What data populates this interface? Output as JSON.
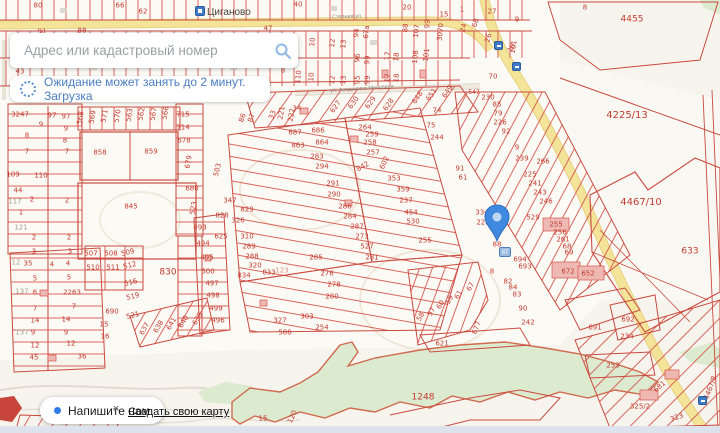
{
  "search": {
    "placeholder": "Адрес или кадастровый номер"
  },
  "loader": {
    "text": "Ожидание может занять до 2 минут. Загрузка"
  },
  "footer": {
    "chat_label": "Напишите нам",
    "close_label": "×",
    "create_map_label": "Создать свою карту"
  },
  "map": {
    "place_label": "Циганово",
    "street_labels": [
      {
        "text": "Степная ул."
      },
      {
        "text": "ул. Академика Мичурина"
      },
      {
        "text": "ул."
      }
    ],
    "marker": {
      "parcel": "88",
      "badge": "87"
    },
    "colors": {
      "parcel_line": "#d6554b",
      "parcel_text": "#c23b30",
      "road_fill": "#f3e49a",
      "forest": "#dcead0",
      "pin": "#3f8ae0",
      "ui_accent": "#4a7dc0"
    },
    "parcel_labels": [
      {
        "t": "80",
        "x": 38,
        "y": 6
      },
      {
        "t": "66",
        "x": 120,
        "y": 6
      },
      {
        "t": "62",
        "x": 143,
        "y": 12
      },
      {
        "t": "91",
        "x": 42,
        "y": 32
      },
      {
        "t": "88",
        "x": 82,
        "y": 31
      },
      {
        "t": "47",
        "x": 268,
        "y": 29
      },
      {
        "t": "40",
        "x": 298,
        "y": 5
      },
      {
        "t": "20",
        "x": 407,
        "y": 8
      },
      {
        "t": "15",
        "x": 444,
        "y": 15
      },
      {
        "t": "1",
        "x": 462,
        "y": 10
      },
      {
        "t": "27",
        "x": 492,
        "y": 12
      },
      {
        "t": "9",
        "x": 517,
        "y": 20
      },
      {
        "t": "8",
        "x": 585,
        "y": 8
      },
      {
        "t": "4455",
        "x": 632,
        "y": 20,
        "s": 9
      },
      {
        "t": "24",
        "x": 464,
        "y": 28,
        "r": -75
      },
      {
        "t": "68",
        "x": 476,
        "y": 23,
        "r": -75
      },
      {
        "t": "26",
        "x": 489,
        "y": 38,
        "r": -75
      },
      {
        "t": "101",
        "x": 514,
        "y": 47,
        "r": -80
      },
      {
        "t": "3070",
        "x": 441,
        "y": 32,
        "r": -85
      },
      {
        "t": "107",
        "x": 417,
        "y": 31,
        "r": -85
      },
      {
        "t": "99",
        "x": 428,
        "y": 24,
        "r": -85
      },
      {
        "t": "88",
        "x": 406,
        "y": 28,
        "r": -85
      },
      {
        "t": "94",
        "x": 357,
        "y": 33,
        "r": -85
      },
      {
        "t": "67а",
        "x": 367,
        "y": 32,
        "r": -85
      },
      {
        "t": "10",
        "x": 313,
        "y": 42,
        "r": -85
      },
      {
        "t": "12",
        "x": 333,
        "y": 43,
        "r": -85
      },
      {
        "t": "13",
        "x": 344,
        "y": 44,
        "r": -85
      },
      {
        "t": "96",
        "x": 358,
        "y": 58,
        "r": -85
      },
      {
        "t": "99",
        "x": 368,
        "y": 60,
        "r": -85
      },
      {
        "t": "17",
        "x": 388,
        "y": 56,
        "r": -85
      },
      {
        "t": "18",
        "x": 397,
        "y": 57,
        "r": -85
      },
      {
        "t": "108",
        "x": 416,
        "y": 57,
        "r": -85
      },
      {
        "t": "101",
        "x": 427,
        "y": 55,
        "r": -85
      },
      {
        "t": "95",
        "x": 358,
        "y": 80,
        "r": -85
      },
      {
        "t": "99",
        "x": 368,
        "y": 80,
        "r": -85
      },
      {
        "t": "17",
        "x": 388,
        "y": 78,
        "r": -85
      },
      {
        "t": "18",
        "x": 397,
        "y": 78,
        "r": -85
      },
      {
        "t": "12",
        "x": 333,
        "y": 80,
        "r": -85
      },
      {
        "t": "13",
        "x": 344,
        "y": 80,
        "r": -85
      },
      {
        "t": "110",
        "x": 299,
        "y": 77,
        "r": -85
      },
      {
        "t": "10",
        "x": 312,
        "y": 77,
        "r": -85
      },
      {
        "t": "8",
        "x": 283,
        "y": 71
      },
      {
        "t": "43",
        "x": 20,
        "y": 72
      },
      {
        "t": "10",
        "x": 512,
        "y": 48,
        "r": -60
      },
      {
        "t": "70",
        "x": 493,
        "y": 77
      },
      {
        "t": "547",
        "x": 474,
        "y": 93,
        "s": 6
      },
      {
        "t": "230",
        "x": 488,
        "y": 98
      },
      {
        "t": "85",
        "x": 497,
        "y": 105
      },
      {
        "t": "74",
        "x": 437,
        "y": 111
      },
      {
        "t": "75",
        "x": 431,
        "y": 126
      },
      {
        "t": "244",
        "x": 437,
        "y": 138
      },
      {
        "t": "627",
        "x": 336,
        "y": 107,
        "r": -55
      },
      {
        "t": "630",
        "x": 354,
        "y": 103,
        "r": -55
      },
      {
        "t": "629",
        "x": 371,
        "y": 103,
        "r": -55
      },
      {
        "t": "628",
        "x": 389,
        "y": 105,
        "r": -55
      },
      {
        "t": "648",
        "x": 418,
        "y": 98,
        "r": -55
      },
      {
        "t": "651",
        "x": 432,
        "y": 95,
        "r": -55
      },
      {
        "t": "649",
        "x": 448,
        "y": 92,
        "r": -55
      },
      {
        "t": "86",
        "x": 243,
        "y": 118,
        "r": -70
      },
      {
        "t": "87",
        "x": 252,
        "y": 118,
        "r": -70
      },
      {
        "t": "33",
        "x": 273,
        "y": 115,
        "r": -70
      },
      {
        "t": "221",
        "x": 282,
        "y": 113,
        "r": -80
      },
      {
        "t": "222",
        "x": 292,
        "y": 115,
        "r": -80
      },
      {
        "t": "34",
        "x": 297,
        "y": 109
      },
      {
        "t": "3247",
        "x": 20,
        "y": 115
      },
      {
        "t": "97",
        "x": 52,
        "y": 116
      },
      {
        "t": "97",
        "x": 66,
        "y": 117
      },
      {
        "t": "9",
        "x": 41,
        "y": 125
      },
      {
        "t": "9",
        "x": 66,
        "y": 129
      },
      {
        "t": "8",
        "x": 27,
        "y": 136
      },
      {
        "t": "8",
        "x": 65,
        "y": 141
      },
      {
        "t": "7",
        "x": 27,
        "y": 152
      },
      {
        "t": "7",
        "x": 67,
        "y": 152
      },
      {
        "t": "109",
        "x": 13,
        "y": 175
      },
      {
        "t": "110",
        "x": 41,
        "y": 176
      },
      {
        "t": "44",
        "x": 18,
        "y": 191
      },
      {
        "t": "117",
        "x": 15,
        "y": 202,
        "g": 1
      },
      {
        "t": "2",
        "x": 32,
        "y": 200
      },
      {
        "t": "2",
        "x": 67,
        "y": 201
      },
      {
        "t": "1",
        "x": 21,
        "y": 213
      },
      {
        "t": "121",
        "x": 21,
        "y": 228,
        "g": 1
      },
      {
        "t": "2",
        "x": 34,
        "y": 238
      },
      {
        "t": "2",
        "x": 69,
        "y": 238
      },
      {
        "t": "3",
        "x": 34,
        "y": 252
      },
      {
        "t": "3",
        "x": 70,
        "y": 252
      },
      {
        "t": "35",
        "x": 28,
        "y": 264
      },
      {
        "t": "12",
        "x": 16,
        "y": 263,
        "g": 1
      },
      {
        "t": "4",
        "x": 52,
        "y": 265
      },
      {
        "t": "4",
        "x": 68,
        "y": 264
      },
      {
        "t": "5",
        "x": 35,
        "y": 279
      },
      {
        "t": "5",
        "x": 69,
        "y": 278
      },
      {
        "t": "6",
        "x": 35,
        "y": 293
      },
      {
        "t": "137",
        "x": 22,
        "y": 292,
        "g": 1
      },
      {
        "t": "2263",
        "x": 72,
        "y": 293
      },
      {
        "t": "7",
        "x": 35,
        "y": 309
      },
      {
        "t": "7",
        "x": 74,
        "y": 307
      },
      {
        "t": "14",
        "x": 35,
        "y": 321
      },
      {
        "t": "14",
        "x": 66,
        "y": 320
      },
      {
        "t": "9",
        "x": 33,
        "y": 333
      },
      {
        "t": "9",
        "x": 66,
        "y": 333
      },
      {
        "t": "137",
        "x": 22,
        "y": 333,
        "g": 1
      },
      {
        "t": "12",
        "x": 35,
        "y": 346
      },
      {
        "t": "12",
        "x": 71,
        "y": 344
      },
      {
        "t": "45",
        "x": 34,
        "y": 358
      },
      {
        "t": "36",
        "x": 82,
        "y": 357
      },
      {
        "t": "568",
        "x": 81,
        "y": 118,
        "r": -80
      },
      {
        "t": "569",
        "x": 93,
        "y": 117,
        "r": -80
      },
      {
        "t": "571",
        "x": 105,
        "y": 116,
        "r": -80
      },
      {
        "t": "570",
        "x": 118,
        "y": 116,
        "r": -80
      },
      {
        "t": "563",
        "x": 130,
        "y": 115,
        "r": -80
      },
      {
        "t": "562",
        "x": 142,
        "y": 114,
        "r": -80
      },
      {
        "t": "567",
        "x": 154,
        "y": 114,
        "r": -80
      },
      {
        "t": "566",
        "x": 166,
        "y": 113,
        "r": -80
      },
      {
        "t": "715",
        "x": 183,
        "y": 115
      },
      {
        "t": "714",
        "x": 183,
        "y": 128
      },
      {
        "t": "678",
        "x": 184,
        "y": 141
      },
      {
        "t": "679",
        "x": 189,
        "y": 162,
        "r": -80
      },
      {
        "t": "858",
        "x": 100,
        "y": 153
      },
      {
        "t": "859",
        "x": 151,
        "y": 152
      },
      {
        "t": "845",
        "x": 131,
        "y": 207
      },
      {
        "t": "680",
        "x": 192,
        "y": 189
      },
      {
        "t": "503",
        "x": 218,
        "y": 170,
        "r": -75
      },
      {
        "t": "523",
        "x": 194,
        "y": 208,
        "r": -80
      },
      {
        "t": "347",
        "x": 230,
        "y": 201
      },
      {
        "t": "829",
        "x": 247,
        "y": 210
      },
      {
        "t": "828",
        "x": 222,
        "y": 216
      },
      {
        "t": "493",
        "x": 200,
        "y": 228
      },
      {
        "t": "625",
        "x": 221,
        "y": 237
      },
      {
        "t": "494",
        "x": 203,
        "y": 244
      },
      {
        "t": "495",
        "x": 207,
        "y": 258
      },
      {
        "t": "500",
        "x": 208,
        "y": 272
      },
      {
        "t": "497",
        "x": 212,
        "y": 284
      },
      {
        "t": "498",
        "x": 213,
        "y": 296
      },
      {
        "t": "499",
        "x": 216,
        "y": 309
      },
      {
        "t": "496",
        "x": 218,
        "y": 321
      },
      {
        "t": "326",
        "x": 238,
        "y": 221
      },
      {
        "t": "310",
        "x": 247,
        "y": 237
      },
      {
        "t": "289",
        "x": 249,
        "y": 247
      },
      {
        "t": "288",
        "x": 252,
        "y": 257
      },
      {
        "t": "320",
        "x": 255,
        "y": 266
      },
      {
        "t": "833",
        "x": 269,
        "y": 273
      },
      {
        "t": "123",
        "x": 282,
        "y": 271,
        "lt": 1
      },
      {
        "t": "834",
        "x": 244,
        "y": 276
      },
      {
        "t": "830",
        "x": 168,
        "y": 273,
        "s": 9
      },
      {
        "t": "507",
        "x": 91,
        "y": 254
      },
      {
        "t": "508",
        "x": 111,
        "y": 254
      },
      {
        "t": "509",
        "x": 128,
        "y": 253,
        "r": -15
      },
      {
        "t": "510",
        "x": 93,
        "y": 268
      },
      {
        "t": "511",
        "x": 113,
        "y": 268
      },
      {
        "t": "512",
        "x": 130,
        "y": 266,
        "r": -15
      },
      {
        "t": "516",
        "x": 131,
        "y": 283,
        "r": -15
      },
      {
        "t": "519",
        "x": 133,
        "y": 297,
        "r": -15
      },
      {
        "t": "690",
        "x": 112,
        "y": 312
      },
      {
        "t": "521",
        "x": 133,
        "y": 316,
        "r": -15
      },
      {
        "t": "15",
        "x": 104,
        "y": 325
      },
      {
        "t": "16",
        "x": 105,
        "y": 337
      },
      {
        "t": "637",
        "x": 145,
        "y": 329,
        "r": -60
      },
      {
        "t": "638",
        "x": 159,
        "y": 327,
        "r": -60
      },
      {
        "t": "641",
        "x": 172,
        "y": 324,
        "r": -60
      },
      {
        "t": "640",
        "x": 184,
        "y": 322,
        "r": -60
      },
      {
        "t": "639",
        "x": 198,
        "y": 319,
        "r": -60
      },
      {
        "t": "687",
        "x": 295,
        "y": 133
      },
      {
        "t": "686",
        "x": 318,
        "y": 131
      },
      {
        "t": "863",
        "x": 298,
        "y": 146
      },
      {
        "t": "864",
        "x": 322,
        "y": 143
      },
      {
        "t": "283",
        "x": 317,
        "y": 157
      },
      {
        "t": "294",
        "x": 322,
        "y": 167
      },
      {
        "t": "291",
        "x": 333,
        "y": 184
      },
      {
        "t": "290",
        "x": 334,
        "y": 195
      },
      {
        "t": "286",
        "x": 345,
        "y": 207
      },
      {
        "t": "284",
        "x": 350,
        "y": 217
      },
      {
        "t": "287",
        "x": 357,
        "y": 227
      },
      {
        "t": "273",
        "x": 362,
        "y": 237
      },
      {
        "t": "527",
        "x": 367,
        "y": 247
      },
      {
        "t": "281",
        "x": 372,
        "y": 258
      },
      {
        "t": "264",
        "x": 365,
        "y": 128
      },
      {
        "t": "259",
        "x": 372,
        "y": 135
      },
      {
        "t": "258",
        "x": 370,
        "y": 143
      },
      {
        "t": "257",
        "x": 373,
        "y": 153
      },
      {
        "t": "842",
        "x": 363,
        "y": 167,
        "r": -30
      },
      {
        "t": "602",
        "x": 385,
        "y": 163,
        "r": -65
      },
      {
        "t": "353",
        "x": 394,
        "y": 179
      },
      {
        "t": "359",
        "x": 403,
        "y": 190
      },
      {
        "t": "237",
        "x": 406,
        "y": 201
      },
      {
        "t": "454",
        "x": 411,
        "y": 213
      },
      {
        "t": "530",
        "x": 413,
        "y": 222
      },
      {
        "t": "255",
        "x": 425,
        "y": 241
      },
      {
        "t": "91",
        "x": 460,
        "y": 169
      },
      {
        "t": "61",
        "x": 463,
        "y": 178
      },
      {
        "t": "285",
        "x": 316,
        "y": 258
      },
      {
        "t": "276",
        "x": 327,
        "y": 274
      },
      {
        "t": "278",
        "x": 334,
        "y": 285
      },
      {
        "t": "280",
        "x": 332,
        "y": 297
      },
      {
        "t": "303",
        "x": 307,
        "y": 317
      },
      {
        "t": "327",
        "x": 280,
        "y": 321
      },
      {
        "t": "586",
        "x": 285,
        "y": 333
      },
      {
        "t": "254",
        "x": 322,
        "y": 328
      },
      {
        "t": "9",
        "x": 517,
        "y": 148
      },
      {
        "t": "239",
        "x": 522,
        "y": 159
      },
      {
        "t": "266",
        "x": 543,
        "y": 162
      },
      {
        "t": "225",
        "x": 530,
        "y": 175
      },
      {
        "t": "241",
        "x": 535,
        "y": 184
      },
      {
        "t": "243",
        "x": 540,
        "y": 193
      },
      {
        "t": "246",
        "x": 546,
        "y": 202
      },
      {
        "t": "529",
        "x": 533,
        "y": 218
      },
      {
        "t": "255",
        "x": 556,
        "y": 225
      },
      {
        "t": "256",
        "x": 560,
        "y": 233
      },
      {
        "t": "261",
        "x": 563,
        "y": 240
      },
      {
        "t": "68",
        "x": 567,
        "y": 247
      },
      {
        "t": "69",
        "x": 569,
        "y": 253
      },
      {
        "t": "79",
        "x": 498,
        "y": 114
      },
      {
        "t": "226",
        "x": 500,
        "y": 123
      },
      {
        "t": "92",
        "x": 506,
        "y": 132
      },
      {
        "t": "334",
        "x": 482,
        "y": 213
      },
      {
        "t": "228",
        "x": 483,
        "y": 223
      },
      {
        "t": "88",
        "x": 497,
        "y": 245
      },
      {
        "t": "694",
        "x": 520,
        "y": 260
      },
      {
        "t": "693",
        "x": 525,
        "y": 267
      },
      {
        "t": "8",
        "x": 492,
        "y": 272
      },
      {
        "t": "82",
        "x": 508,
        "y": 282
      },
      {
        "t": "84",
        "x": 513,
        "y": 288
      },
      {
        "t": "83",
        "x": 517,
        "y": 295
      },
      {
        "t": "90",
        "x": 523,
        "y": 309
      },
      {
        "t": "242",
        "x": 528,
        "y": 323
      },
      {
        "t": "691",
        "x": 595,
        "y": 328
      },
      {
        "t": "692",
        "x": 628,
        "y": 320
      },
      {
        "t": "234",
        "x": 627,
        "y": 337
      },
      {
        "t": "253",
        "x": 613,
        "y": 366
      },
      {
        "t": "672",
        "x": 568,
        "y": 272
      },
      {
        "t": "652",
        "x": 588,
        "y": 274
      },
      {
        "t": "677",
        "x": 477,
        "y": 328,
        "r": -70
      },
      {
        "t": "621",
        "x": 442,
        "y": 344
      },
      {
        "t": "58",
        "x": 421,
        "y": 317,
        "r": -60
      },
      {
        "t": "57",
        "x": 432,
        "y": 312,
        "r": -60
      },
      {
        "t": "60",
        "x": 441,
        "y": 305,
        "r": -60
      },
      {
        "t": "59",
        "x": 450,
        "y": 300,
        "r": -60
      },
      {
        "t": "61",
        "x": 459,
        "y": 295,
        "r": -60
      },
      {
        "t": "67",
        "x": 471,
        "y": 287,
        "r": -60
      },
      {
        "t": "4225/13",
        "x": 627,
        "y": 116,
        "s": 10
      },
      {
        "t": "4467/10",
        "x": 641,
        "y": 203,
        "s": 10
      },
      {
        "t": "633",
        "x": 690,
        "y": 252,
        "s": 9
      },
      {
        "t": "1248",
        "x": 423,
        "y": 398,
        "s": 9
      },
      {
        "t": "681",
        "x": 660,
        "y": 387,
        "r": -40
      },
      {
        "t": "325/2",
        "x": 640,
        "y": 407
      },
      {
        "t": "323",
        "x": 677,
        "y": 418,
        "r": -20
      },
      {
        "t": "4467/8",
        "x": 711,
        "y": 388,
        "r": -70
      },
      {
        "t": "15",
        "x": 263,
        "y": 419
      },
      {
        "t": "120",
        "x": 293,
        "y": 417,
        "r": -65
      }
    ]
  }
}
